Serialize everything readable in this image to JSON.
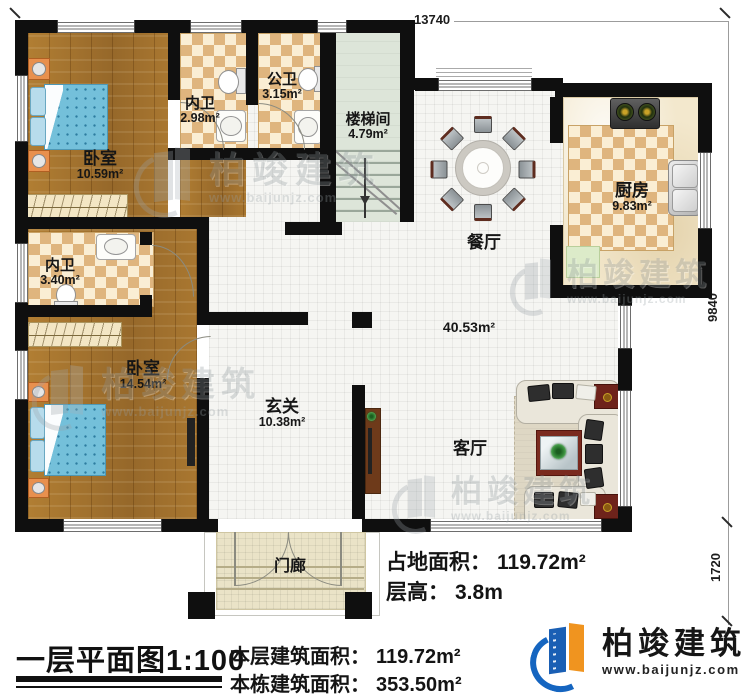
{
  "dimensions": {
    "top": "13740",
    "right_upper": "9840",
    "right_lower": "1720"
  },
  "rooms": {
    "bedroom1": {
      "name": "卧室",
      "area": "10.59m²"
    },
    "bath1": {
      "name": "内卫",
      "area": "2.98m²"
    },
    "public_bath": {
      "name": "公卫",
      "area": "3.15m²"
    },
    "stairwell": {
      "name": "楼梯间",
      "area": "4.79m²"
    },
    "dining": {
      "name": "餐厅"
    },
    "kitchen": {
      "name": "厨房",
      "area": "9.83m²"
    },
    "bath2": {
      "name": "内卫",
      "area": "3.40m²"
    },
    "bedroom2": {
      "name": "卧室",
      "area": "14.54m²"
    },
    "foyer": {
      "name": "玄关",
      "area": "10.38m²"
    },
    "living": {
      "name": "客厅"
    },
    "porch": {
      "name": "门廊"
    },
    "open_area": "40.53m²"
  },
  "footer": {
    "title": "一层平面图1:100",
    "land_area_label": "占地面积：",
    "land_area_value": "119.72m²",
    "floor_height_label": "层高：",
    "floor_height_value": "3.8m",
    "floor_area_label": "本层建筑面积：",
    "floor_area_value": "119.72m²",
    "building_area_label": "本栋建筑面积：",
    "building_area_value": "353.50m²"
  },
  "brand": {
    "name": "柏竣建筑",
    "url": "www.baijunjz.com"
  },
  "watermark": {
    "name": "柏竣建筑",
    "url": "www.baijunjz.com"
  },
  "colors": {
    "wall": "#0f0f0f",
    "brand_blue": "#1565c0",
    "brand_orange": "#f0941f"
  }
}
